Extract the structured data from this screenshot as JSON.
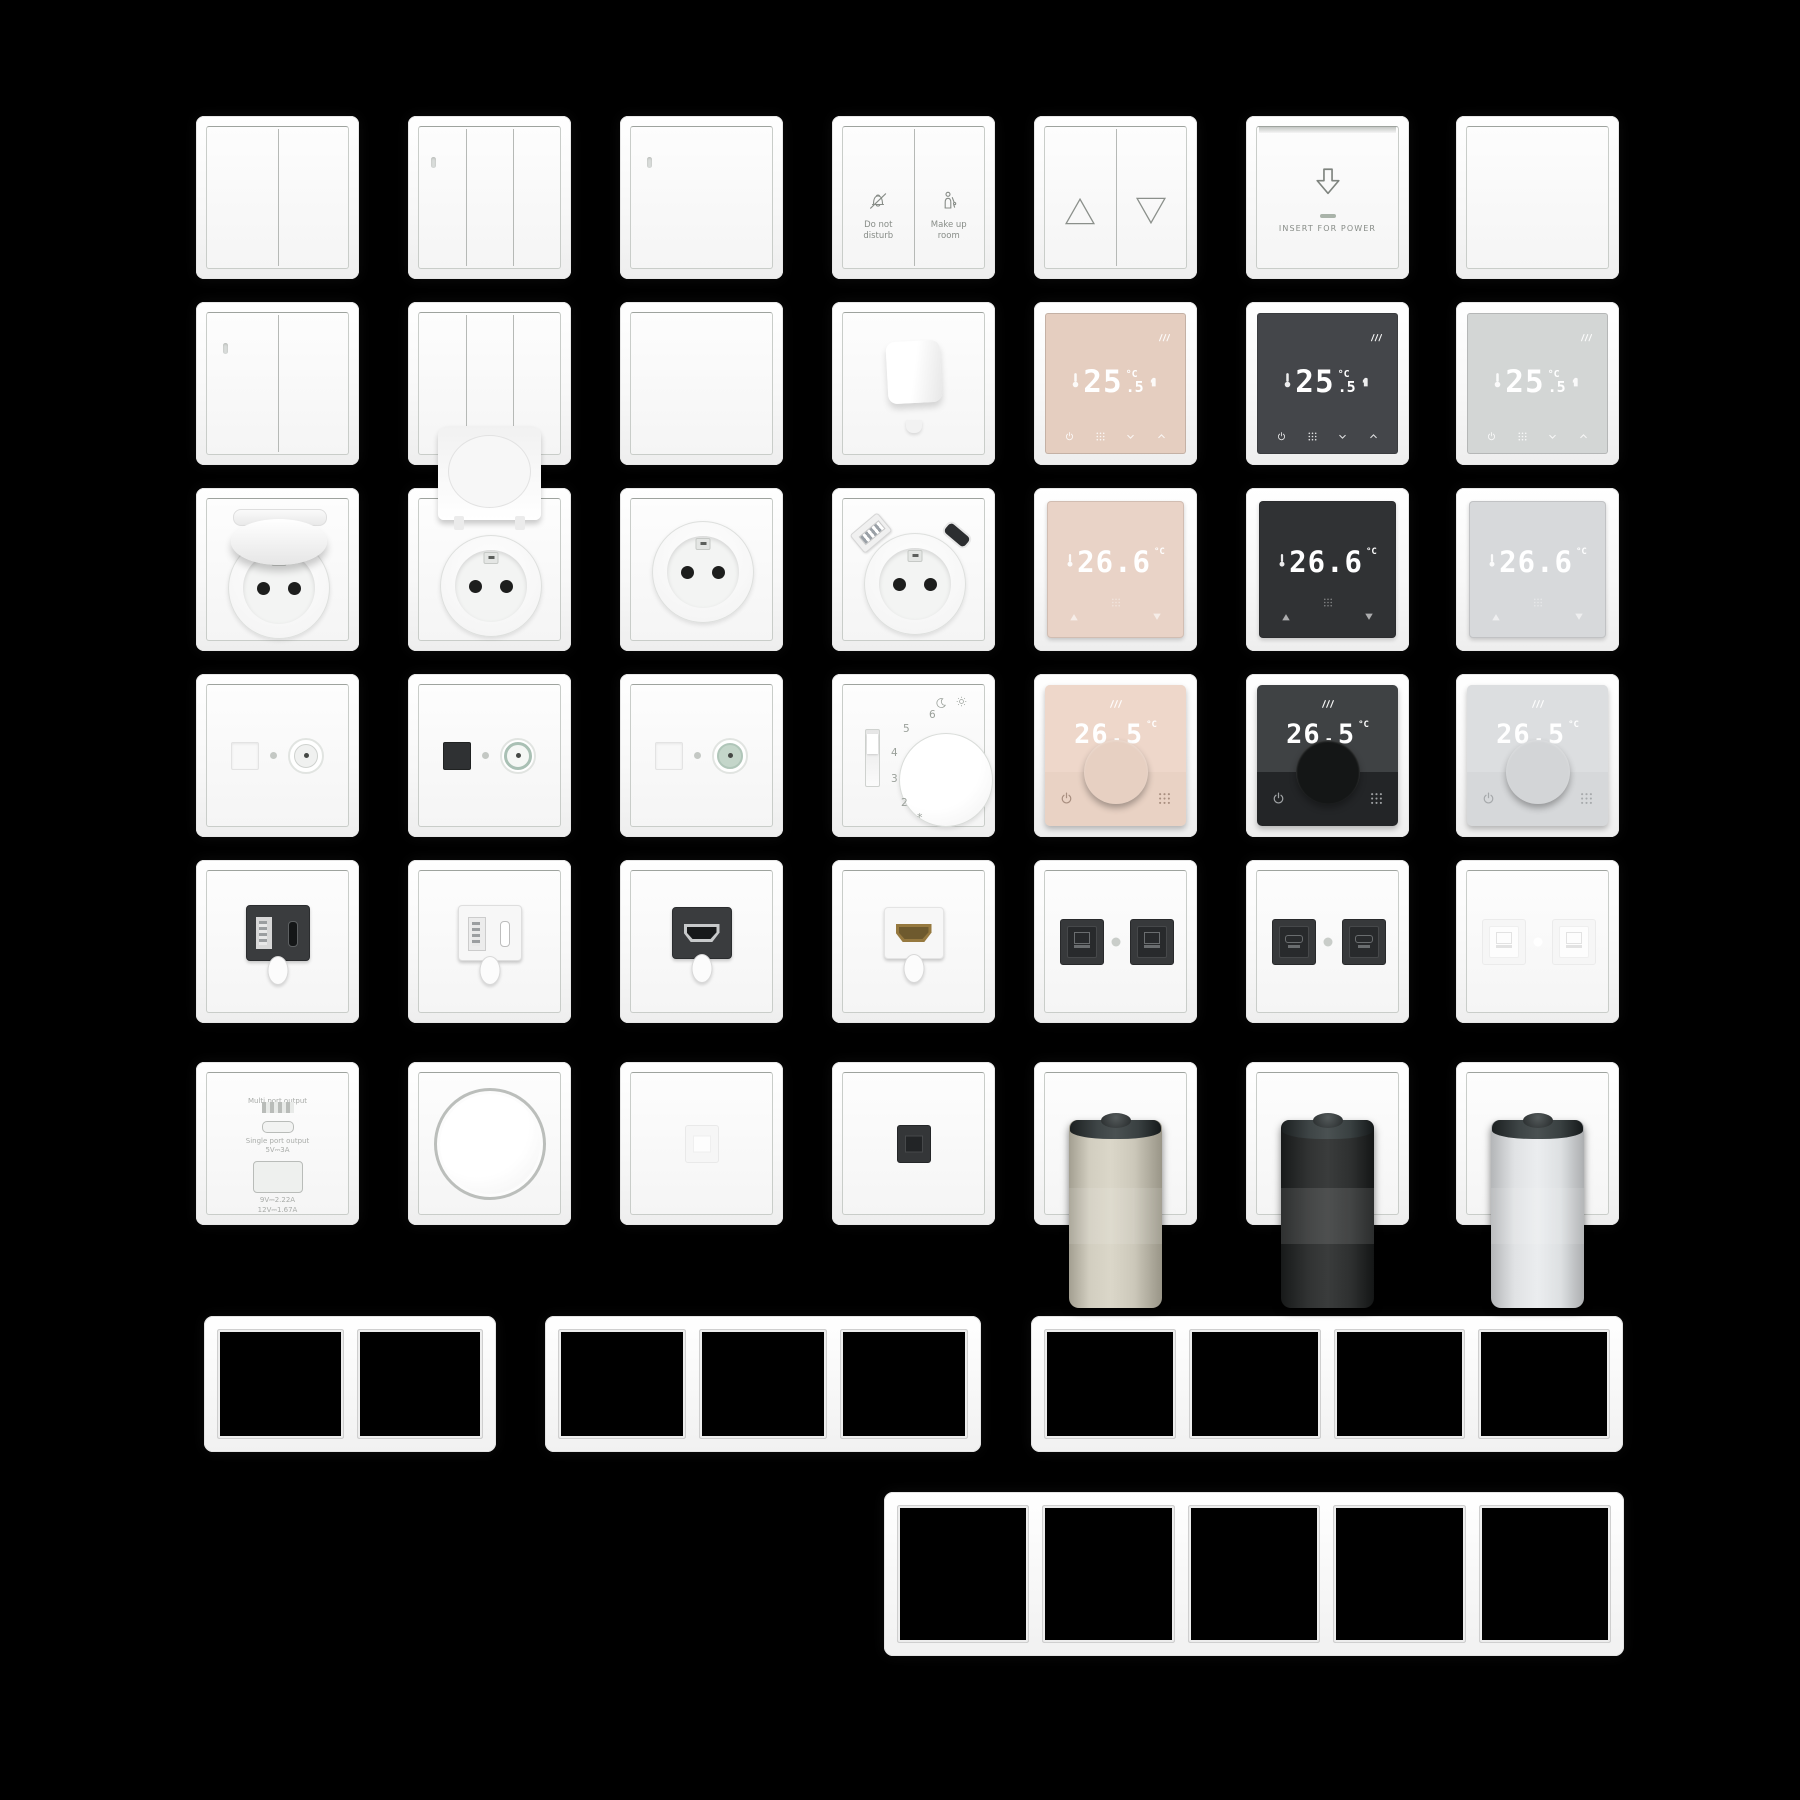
{
  "canvas": {
    "background": "#000000",
    "width": 1800,
    "height": 1800
  },
  "palette": {
    "plate_white": "#fafafa",
    "print_gray": "#878c87",
    "touch_beige": "#e5cec0",
    "touch_black": "#44464a",
    "touch_gray": "#d3d6d5",
    "disp_beige": "#e9d3c7",
    "disp_black": "#303234",
    "disp_gray": "#d7d9db",
    "knob_pink_screen": "#eed7ca",
    "knob_pink_body": "#e9d2c4",
    "knob_pink_knob": "#e7d0c2",
    "knob_black_screen": "#3f4244",
    "knob_black_body": "#232527",
    "knob_black_knob": "#141616",
    "knob_gray_screen": "#dcdee0",
    "knob_gray_body": "#d6d8da",
    "knob_gray_knob": "#d3d5d7",
    "module_dark": "#3a3c3e",
    "hdmi_gold": "#96793f",
    "valve_beige": "#cfcbbd",
    "valve_black": "#2e3030",
    "valve_white": "#e0e2e4",
    "teal_ring": "#a9c0b4",
    "display_digits": "#ffffff"
  },
  "rows": [
    {
      "y": 116,
      "devices": [
        {
          "x": 196,
          "type": "rocker",
          "gangs": 2,
          "led": false,
          "name": "switch-2gang"
        },
        {
          "x": 408,
          "type": "rocker",
          "gangs": 3,
          "led": true,
          "name": "switch-3gang-led"
        },
        {
          "x": 620,
          "type": "rocker",
          "gangs": 1,
          "led": true,
          "name": "switch-1gang-led"
        },
        {
          "x": 832,
          "type": "hotel",
          "name": "hotel-service-switch",
          "left_label": "Do not\ndisturb",
          "right_label": "Make up\nroom",
          "left_icon": "bell-off-icon",
          "right_icon": "housekeeping-icon"
        },
        {
          "x": 1034,
          "type": "blinds",
          "name": "shutter-switch",
          "icons": [
            "triangle-up-icon",
            "triangle-down-icon"
          ]
        },
        {
          "x": 1246,
          "type": "card",
          "name": "key-card-holder",
          "label": "INSERT FOR POWER",
          "icon": "arrow-down-icon"
        },
        {
          "x": 1456,
          "type": "rocker",
          "gangs": 1,
          "led": false,
          "name": "switch-1gang-plain"
        }
      ]
    },
    {
      "y": 302,
      "devices": [
        {
          "x": 196,
          "type": "rocker",
          "gangs": 2,
          "led": true,
          "name": "switch-2gang-led"
        },
        {
          "x": 408,
          "type": "rocker",
          "gangs": 3,
          "led": false,
          "name": "switch-3gang-plain"
        },
        {
          "x": 620,
          "type": "blank",
          "name": "blank-cover"
        },
        {
          "x": 832,
          "type": "cable",
          "name": "cable-outlet"
        },
        {
          "x": 1034,
          "type": "thermo_touch",
          "variant": "beige",
          "name": "touch-thermostat-beige",
          "temp": "25",
          "frac": ".5",
          "unit": "°C",
          "icons": [
            "heating-icon",
            "thermometer-icon",
            "touch-hand-icon",
            "power-icon",
            "menu-grid-icon",
            "chevron-down-icon",
            "chevron-up-icon"
          ]
        },
        {
          "x": 1246,
          "type": "thermo_touch",
          "variant": "black",
          "name": "touch-thermostat-black",
          "temp": "25",
          "frac": ".5",
          "unit": "°C"
        },
        {
          "x": 1456,
          "type": "thermo_touch",
          "variant": "gray",
          "name": "touch-thermostat-gray",
          "temp": "25",
          "frac": ".5",
          "unit": "°C"
        }
      ]
    },
    {
      "y": 488,
      "devices": [
        {
          "x": 196,
          "type": "socket",
          "lid": "closed",
          "name": "socket-hinged-lid"
        },
        {
          "x": 408,
          "type": "socket",
          "lid": "open",
          "name": "socket-lid-open"
        },
        {
          "x": 620,
          "type": "socket",
          "lid": "none",
          "name": "socket-schuko"
        },
        {
          "x": 832,
          "type": "socket_usb",
          "name": "socket-usb-charging"
        },
        {
          "x": 1034,
          "type": "thermo_square",
          "variant": "beige",
          "name": "display-thermostat-beige",
          "temp": "26.6",
          "unit": "°C",
          "icons": [
            "thermometer-icon",
            "triangle-up-icon",
            "menu-grid-icon",
            "triangle-down-icon"
          ]
        },
        {
          "x": 1246,
          "type": "thermo_square",
          "variant": "black",
          "name": "display-thermostat-black",
          "temp": "26.6",
          "unit": "°C"
        },
        {
          "x": 1456,
          "type": "thermo_square",
          "variant": "gray",
          "name": "display-thermostat-gray",
          "temp": "26.6",
          "unit": "°C"
        }
      ]
    },
    {
      "y": 674,
      "devices": [
        {
          "x": 196,
          "type": "tv",
          "variant": "white",
          "name": "media-outlet-white"
        },
        {
          "x": 408,
          "type": "tv",
          "variant": "dark",
          "name": "media-outlet-black-port"
        },
        {
          "x": 620,
          "type": "tv",
          "variant": "teal",
          "name": "media-outlet-teal"
        },
        {
          "x": 832,
          "type": "thermo_mech",
          "name": "dial-thermostat",
          "ticks": [
            "6",
            "5",
            "4",
            "3",
            "2"
          ],
          "frost": "*",
          "icons": [
            "moon-icon",
            "sun-icon"
          ]
        },
        {
          "x": 1034,
          "type": "thermo_knob",
          "variant": "pink",
          "name": "knob-thermostat-pink",
          "temp": "26.5",
          "unit": "°C",
          "icons": [
            "heating-icon",
            "power-icon",
            "menu-grid-icon"
          ]
        },
        {
          "x": 1246,
          "type": "thermo_knob",
          "variant": "black",
          "name": "knob-thermostat-black",
          "temp": "26.5",
          "unit": "°C"
        },
        {
          "x": 1456,
          "type": "thermo_knob",
          "variant": "gray",
          "name": "knob-thermostat-gray",
          "temp": "26.5",
          "unit": "°C"
        }
      ]
    },
    {
      "y": 860,
      "devices": [
        {
          "x": 196,
          "type": "usb_mod",
          "variant": "dark",
          "name": "usb-outlet-black"
        },
        {
          "x": 408,
          "type": "usb_mod",
          "variant": "light",
          "name": "usb-outlet-white"
        },
        {
          "x": 620,
          "type": "hdmi",
          "variant": "dark",
          "name": "hdmi-outlet-black"
        },
        {
          "x": 832,
          "type": "hdmi",
          "variant": "light",
          "name": "hdmi-outlet-white"
        },
        {
          "x": 1034,
          "type": "keystone",
          "variant": "dark",
          "kind": "rj45",
          "name": "ethernet-outlet-black"
        },
        {
          "x": 1246,
          "type": "keystone",
          "variant": "dark",
          "kind": "rj11",
          "name": "phone-outlet-black"
        },
        {
          "x": 1456,
          "type": "keystone",
          "variant": "light",
          "kind": "rj45",
          "name": "ethernet-outlet-white"
        }
      ]
    },
    {
      "y": 1062,
      "devices": [
        {
          "x": 196,
          "type": "charger",
          "name": "usb-charger-outlet",
          "lines": [
            "Multi port output",
            "5V⎓4A",
            "Single port output",
            "5V⎓3A",
            "9V⎓2.22A",
            "12V⎓1.67A"
          ]
        },
        {
          "x": 408,
          "type": "dimmer",
          "name": "rotary-dimmer"
        },
        {
          "x": 620,
          "type": "mini",
          "variant": "light",
          "name": "module-outlet-white"
        },
        {
          "x": 832,
          "type": "mini",
          "variant": "dark",
          "name": "module-outlet-black"
        },
        {
          "x": 1034,
          "type": "valve",
          "variant": "beige",
          "name": "radiator-valve-beige"
        },
        {
          "x": 1246,
          "type": "valve",
          "variant": "black",
          "name": "radiator-valve-black"
        },
        {
          "x": 1456,
          "type": "valve",
          "variant": "white",
          "name": "radiator-valve-white"
        }
      ]
    }
  ],
  "frames": [
    {
      "name": "frame-2gang",
      "gangs": 2,
      "x": 204,
      "y": 1316,
      "w": 292,
      "h": 136
    },
    {
      "name": "frame-3gang",
      "gangs": 3,
      "x": 545,
      "y": 1316,
      "w": 436,
      "h": 136
    },
    {
      "name": "frame-4gang",
      "gangs": 4,
      "x": 1031,
      "y": 1316,
      "w": 592,
      "h": 136
    },
    {
      "name": "frame-5gang",
      "gangs": 5,
      "x": 884,
      "y": 1492,
      "w": 740,
      "h": 164
    }
  ]
}
